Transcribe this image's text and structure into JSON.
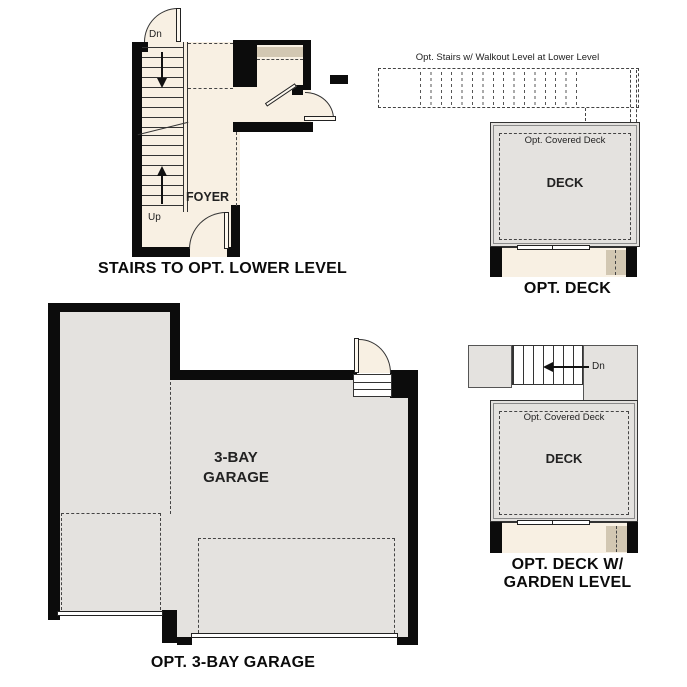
{
  "colors": {
    "floor": "#f8f0e3",
    "surface": "#e4e2df",
    "tan": "#d2c7b2",
    "wall": "#0c0c0c"
  },
  "plans": {
    "stairs_lower_level": {
      "caption": "STAIRS TO OPT. LOWER LEVEL",
      "labels": {
        "down": "Dn",
        "up": "Up",
        "foyer": "FOYER"
      }
    },
    "opt_deck": {
      "caption": "OPT. DECK",
      "labels": {
        "stairs_note": "Opt. Stairs w/ Walkout Level at Lower Level",
        "covered_deck": "Opt. Covered Deck",
        "deck": "DECK"
      }
    },
    "opt_garage": {
      "caption": "OPT. 3-BAY GARAGE",
      "labels": {
        "room_line1": "3-BAY",
        "room_line2": "GARAGE"
      }
    },
    "opt_deck_garden": {
      "caption_line1": "OPT. DECK W/",
      "caption_line2": "GARDEN LEVEL",
      "labels": {
        "down": "Dn",
        "covered_deck": "Opt. Covered Deck",
        "deck": "DECK"
      }
    }
  }
}
